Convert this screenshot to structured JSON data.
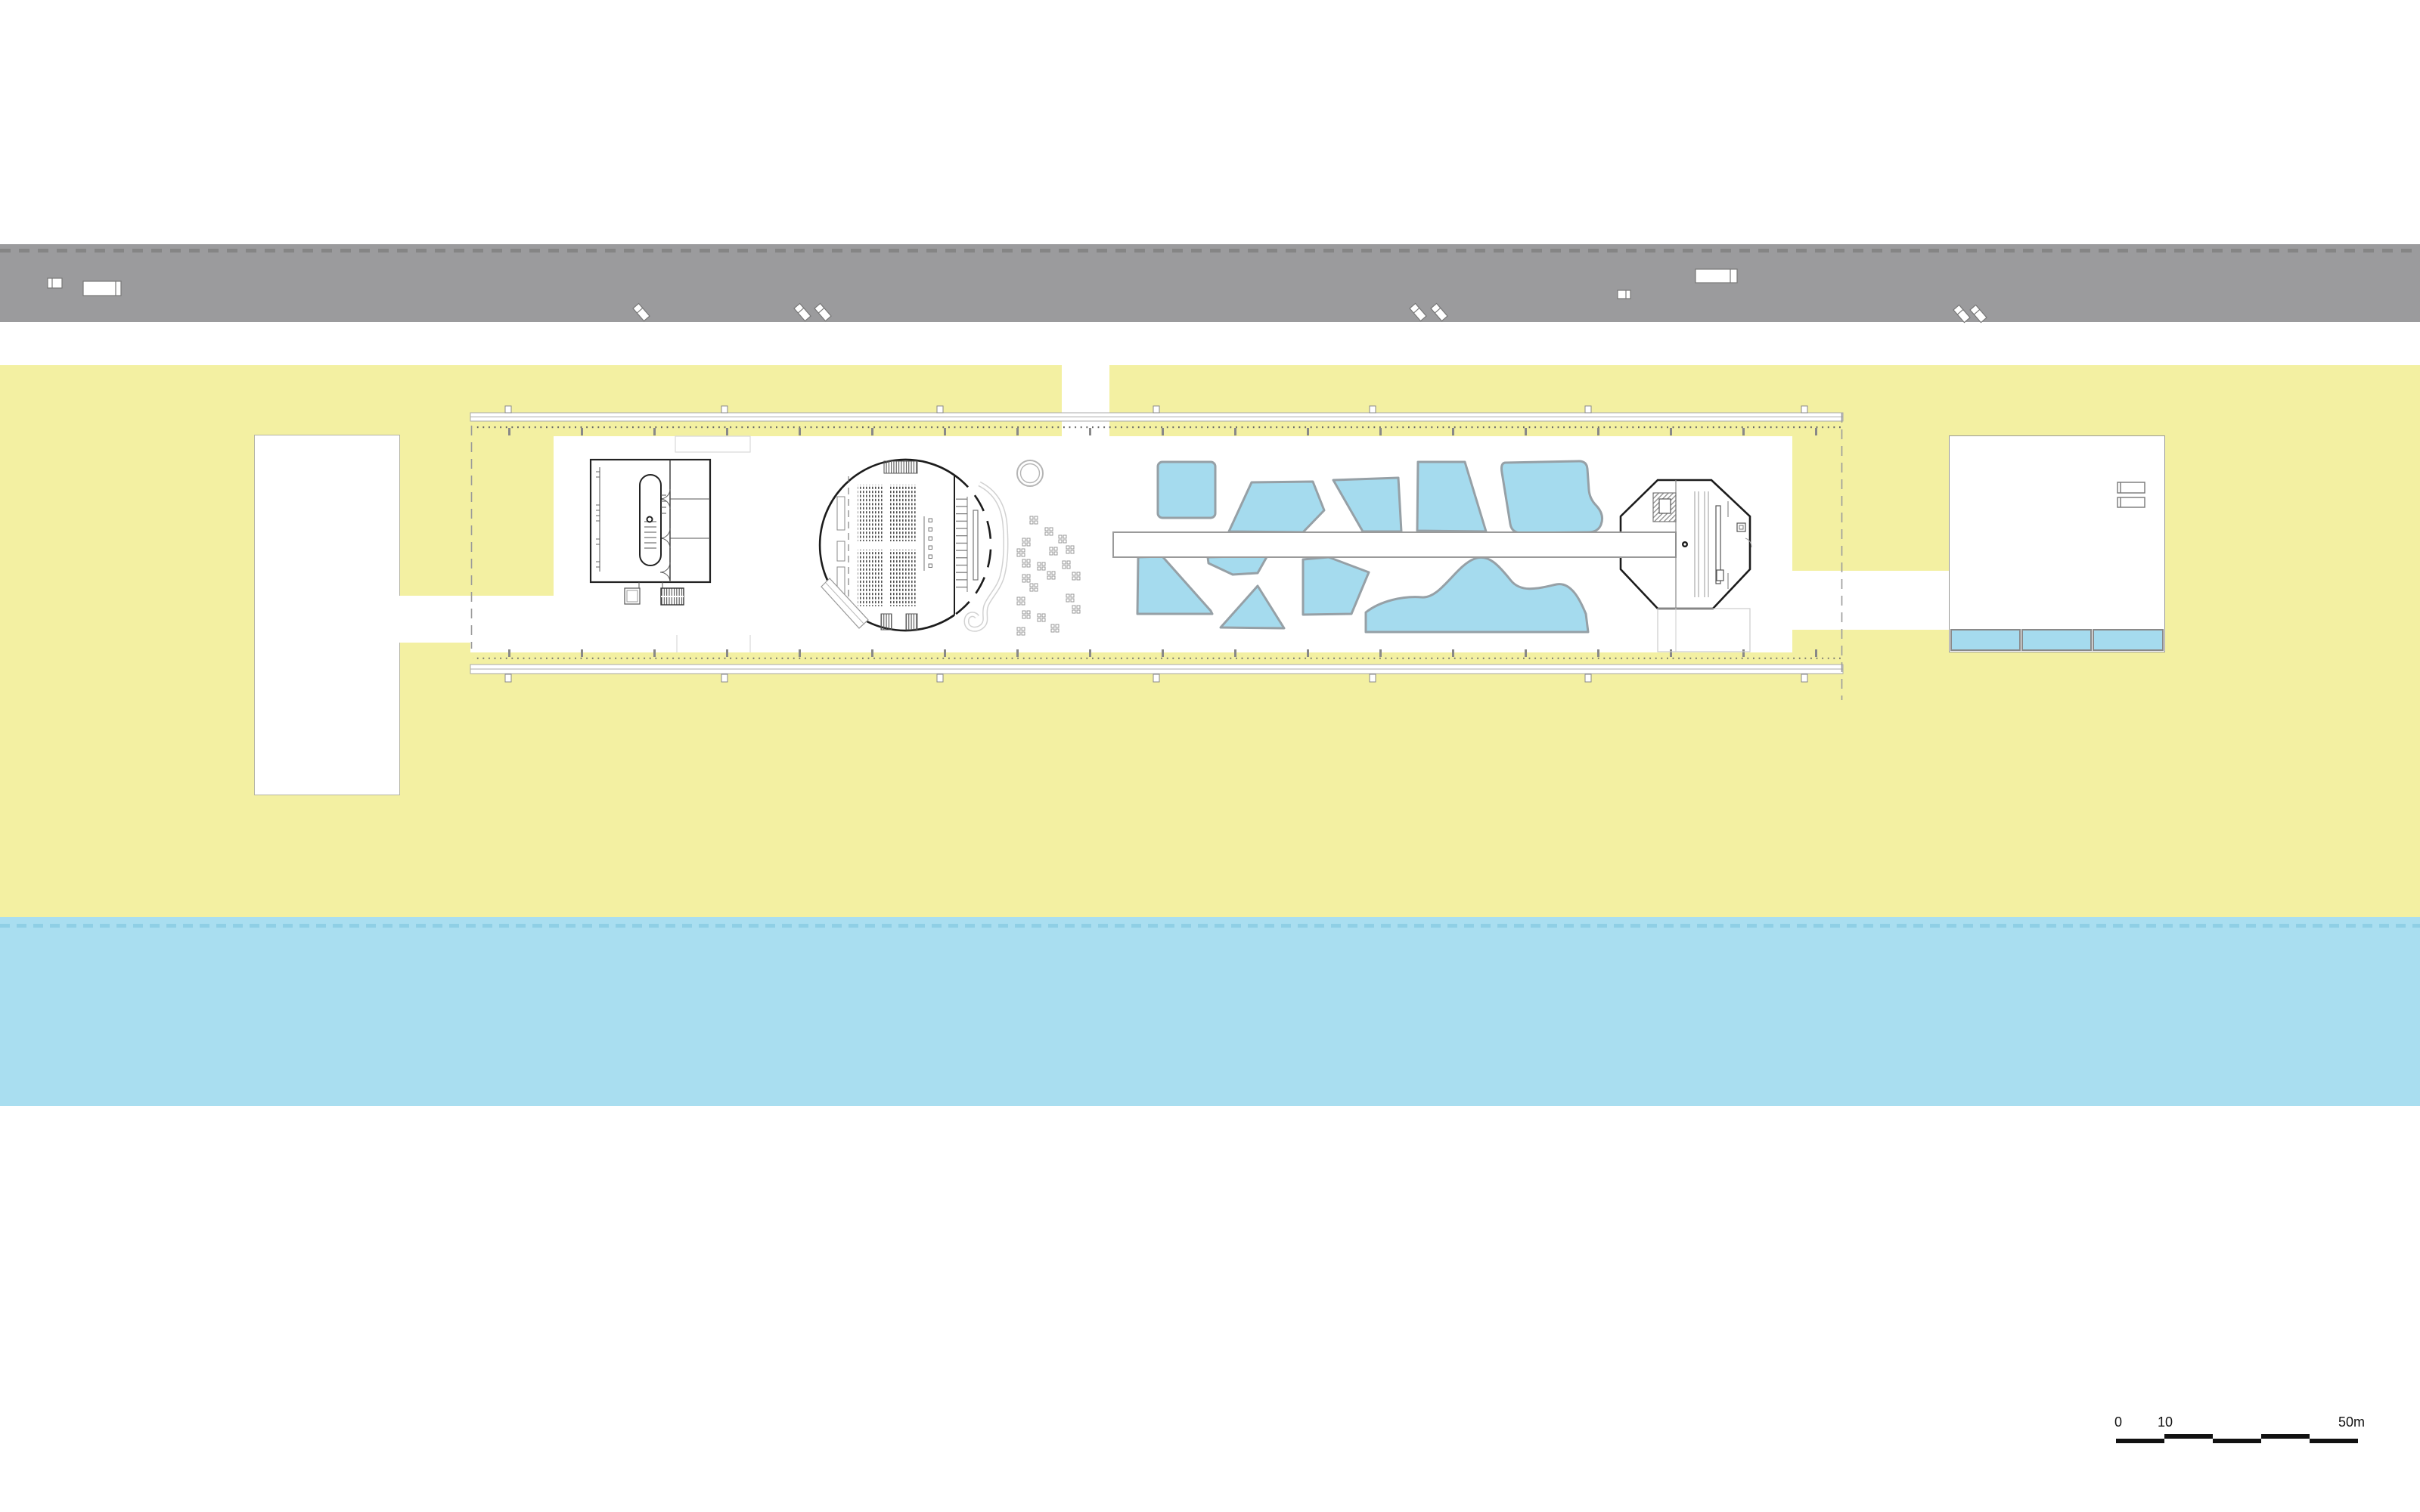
{
  "page": {
    "title": "Architectural site plan — linear pier building on a beach"
  },
  "scalebar": {
    "zero": "0",
    "ten": "10",
    "fifty": "50m"
  },
  "colors": {
    "paper": "#ffffff",
    "land": "#f3f0a2",
    "water": "#a9def0",
    "road": "#9b9b9d",
    "road-dash": "#858585",
    "water-dash": "#8fcfe5",
    "pool": "#a5dbee",
    "pool-stroke": "#96a0a6",
    "ink": "#1c1c1c",
    "mid": "#777777",
    "soft": "#999999",
    "faint": "#d8d8d8"
  },
  "features": {
    "road": {
      "name": "road with parked vehicles",
      "vehicle_count": 11
    },
    "land": {
      "name": "beach strip"
    },
    "water": {
      "name": "sea"
    },
    "left_annex": {
      "name": "left annex block"
    },
    "linear_building": {
      "name": "long boardwalk pier building",
      "elements": [
        "service-block",
        "circular-auditorium",
        "pool-garden",
        "jetty-walkway",
        "octagonal-pavilion"
      ]
    },
    "auditorium": {
      "seat_blocks": 2,
      "rows_per_block": 14
    },
    "pool_garden": {
      "pool_count": 10
    },
    "right_annex": {
      "name": "right annex with lap pools",
      "lap_pools": 3
    }
  }
}
